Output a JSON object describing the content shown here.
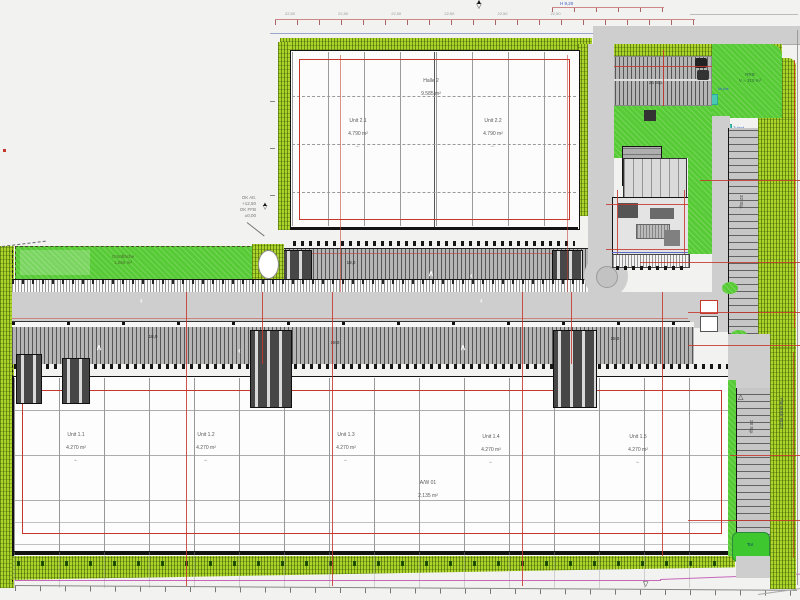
{
  "glyphs": {
    "left_arrow": "←",
    "up_chevron": "∧",
    "left_chevron": "‹",
    "triangle": "△",
    "level_mark": "▽",
    "tri_up": "▲",
    "tri_down": "▽",
    "turn_arrow": "↑"
  },
  "colors": {
    "hedge": "#aed32a",
    "lawn": "#57cb35",
    "road": "#cecece",
    "red_grid": "#c5372b",
    "dim_pink": "#cc8888",
    "boundary_blue": "#9aa6cc",
    "boundary_magenta": "#bb44aa",
    "wall_black": "#141414",
    "teal": "#49c8b4",
    "gate_green": "#3ec72e"
  },
  "dimensions": {
    "top_chain": "22,50 22,50 22,50 22,50 22,50 22,50",
    "top_note": "H 9,20"
  },
  "annotations": {
    "left_note": "OK Att.\n+12,50\nOK FFB\n±0,00",
    "lawn_label": "Grünfläche\n1.050 m²",
    "pond_label": "RRB\nV = 310 m³",
    "pond_tag_1": "Mulde",
    "pond_tag_2": "Zulauf",
    "yard_marks": [
      "18,0",
      "18,0",
      "18,0",
      "18,0"
    ],
    "parking_a_label": "26 Stp.",
    "parking_b_label": "32 Stp.",
    "parking_c_label": "28 Stp.",
    "gate_label": "Tor",
    "right_boundary_note": "Flurstück 842/3"
  },
  "halls": {
    "upper": {
      "center_line1": "Halle 2",
      "center_line2": "9.585 m²",
      "units": [
        {
          "line1": "Unit 2.1",
          "line2": "4.790 m²"
        },
        {
          "line1": "Unit 2.2",
          "line2": "4.790 m²"
        }
      ]
    },
    "lower": {
      "center_line1": "A/W 01",
      "center_line2": "2.135 m²",
      "units": [
        {
          "line1": "Unit 1.1",
          "line2": "4.270 m²"
        },
        {
          "line1": "Unit 1.2",
          "line2": "4.270 m²"
        },
        {
          "line1": "Unit 1.3",
          "line2": "4.270 m²"
        },
        {
          "line1": "Unit 1.4",
          "line2": "4.270 m²"
        },
        {
          "line1": "Unit 1.5",
          "line2": "4.270 m²"
        }
      ]
    }
  }
}
